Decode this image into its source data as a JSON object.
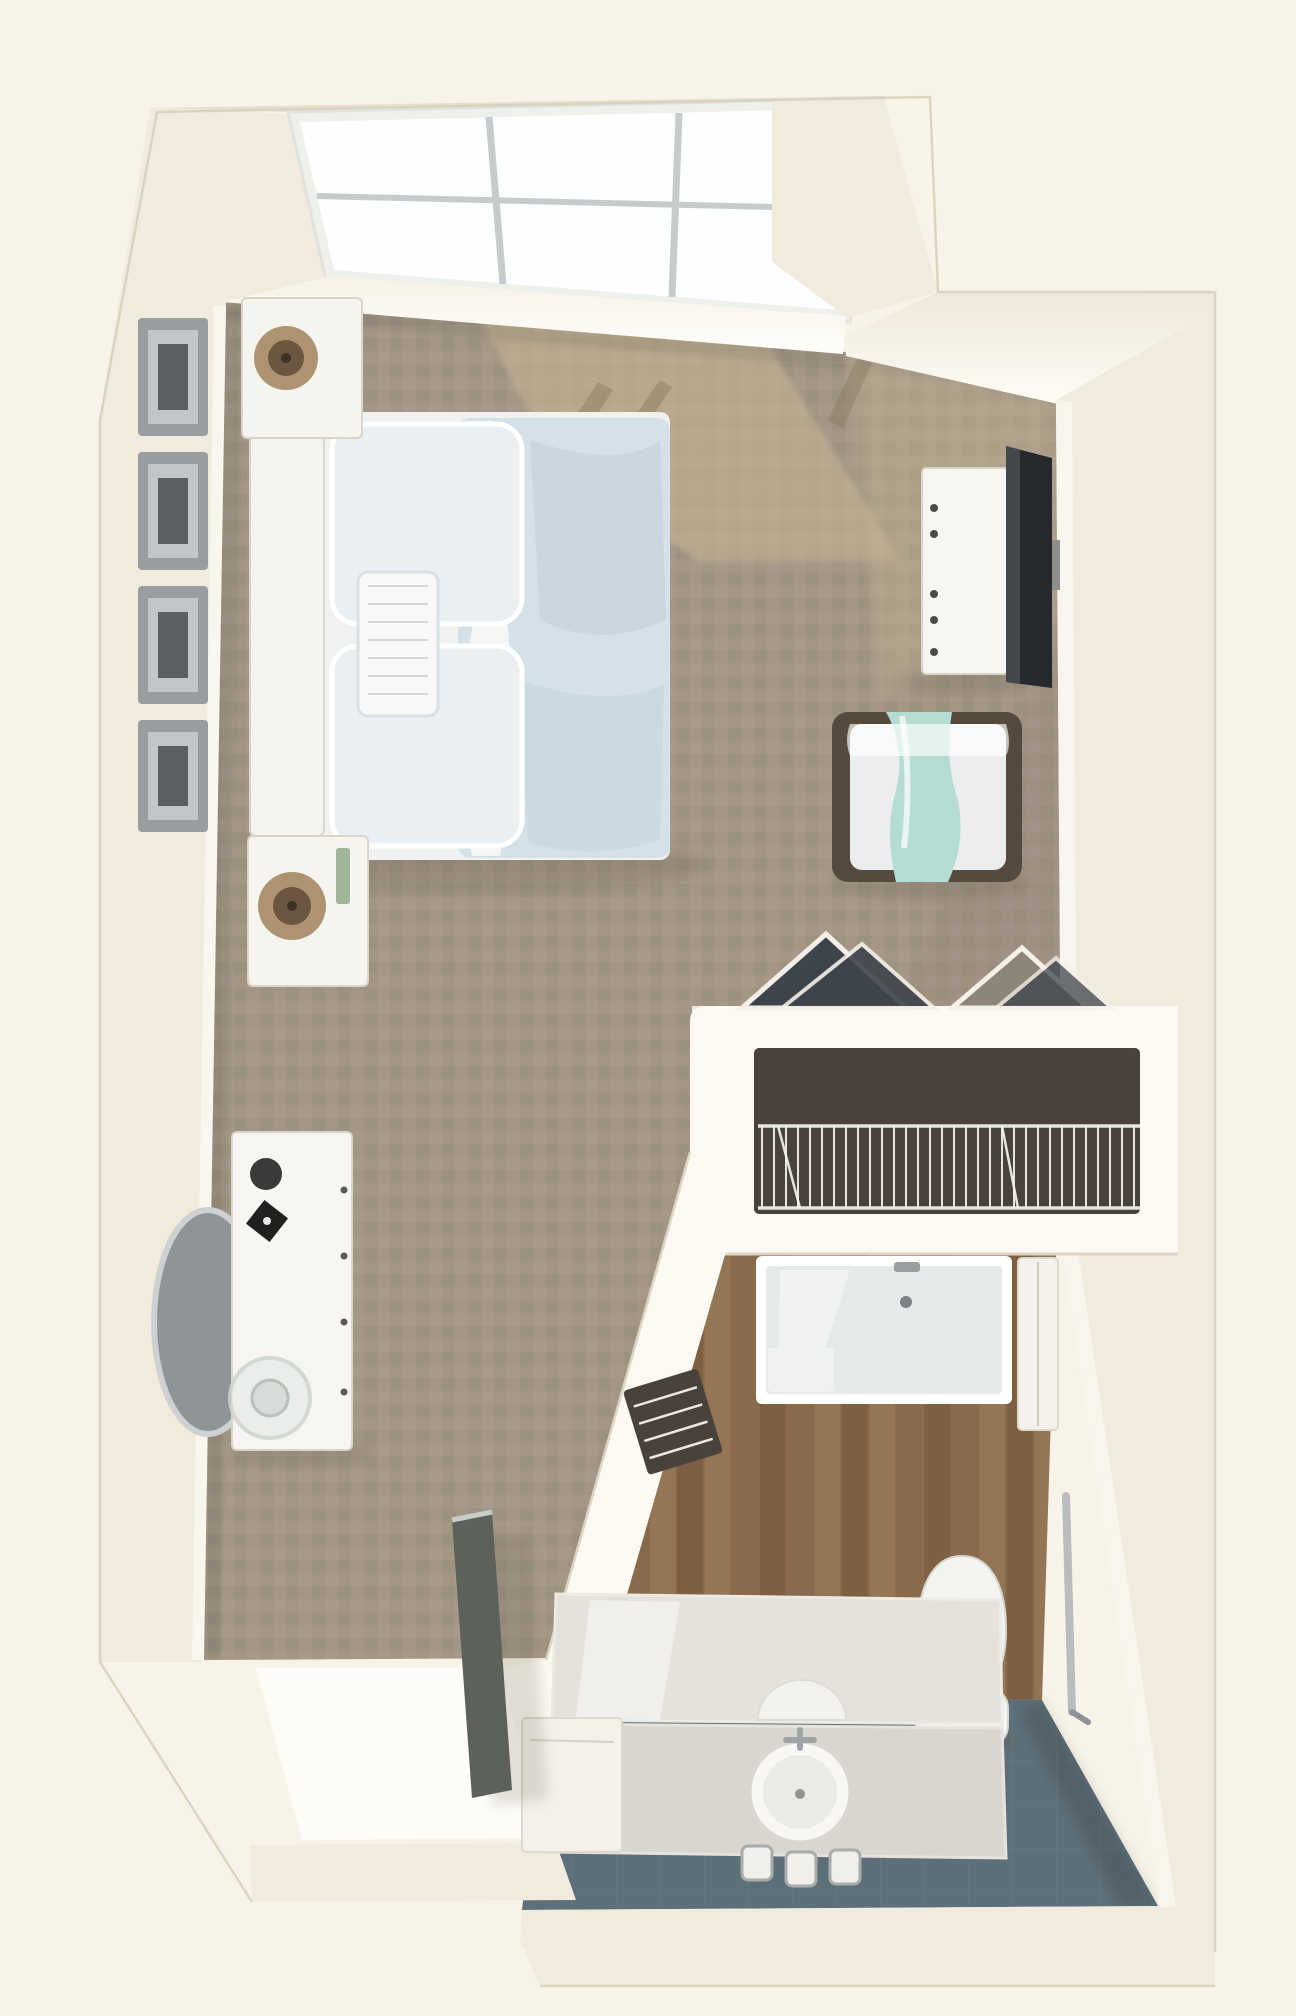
{
  "meta": {
    "title": "Studio Suite 3D Floor Plan",
    "view": "top-down isometric rendering",
    "canvas": {
      "width": 1296,
      "height": 2016
    }
  },
  "palette": {
    "background": "#f8f3e8",
    "wall": "#f1ebdd",
    "wall_bright": "#fbf9f1",
    "wall_edge": "#d8d0bd",
    "carpet": "#a39685",
    "carpet_dark": "#95887b",
    "sun_patch": "#c9b694",
    "sun_shadow": "#8a7a5f",
    "wood_floor": "#8a6a4c",
    "wood_light": "#9d7d5c",
    "wood_dark": "#755638",
    "tile_floor": "#5d6f78",
    "glass": "#fdfeff",
    "mullion": "#c6cbcb",
    "window_frame": "#eef0ec",
    "headboard": "#f4f3ef",
    "bed_base": "#f0f2f1",
    "pillow": "#e9eff3",
    "duvet": "#d5e1e8",
    "duvet_shade": "#bccdd8",
    "runner_white": "#f7f8f7",
    "nightstand": "#f5f4ef",
    "lamp_base": "#ad9372",
    "lamp_dark": "#6b573f",
    "art_frame": "#9a9da0",
    "art_dark": "#5c6063",
    "dresser": "#f6f5f1",
    "tv": "#25292d",
    "chair_frame": "#564a3d",
    "chair_cushion": "#eceded",
    "throw_teal": "#b5dcd2",
    "clothes_dark": "#3e444c",
    "clothes_light": "#8d8678",
    "closet_interior": "#49423a",
    "wire": "#f4f2ec",
    "shower": "#e6e9e9",
    "shower_hi": "#f3f5f4",
    "cabinet": "#f3f1ea",
    "counter": "#d9d6cf",
    "counter_light": "#e4e2db",
    "sink": "#f7f7f4",
    "toilet": "#f3f3ef",
    "door": "#5c615a",
    "mirror_face": "#8f9498",
    "mirror_rim": "#ced1d2",
    "grab_bar": "#b9bdbe",
    "threshold": "#fdfcf7",
    "shadow": "#6b6152"
  },
  "window": {
    "rows": 2,
    "cols": 3,
    "pane_count": 6
  },
  "rooms": [
    {
      "id": "main-room",
      "label": "Bedroom / Living Area",
      "floor": "carpet"
    },
    {
      "id": "closet",
      "label": "Closet",
      "floor": "carpet"
    },
    {
      "id": "bathroom",
      "label": "Bathroom",
      "floor": "wood and tile"
    },
    {
      "id": "entry",
      "label": "Entry",
      "floor": "threshold"
    }
  ],
  "furniture": {
    "bed": {
      "label": "Queen bed with light blue bedding"
    },
    "headboard": {
      "label": "Headboard"
    },
    "pillows": {
      "label": "Pillows"
    },
    "accent_cushion": {
      "label": "Accent cushion"
    },
    "nightstand_window": {
      "label": "Nightstand with lamp (window side)"
    },
    "nightstand_foot": {
      "label": "Nightstand with lamp (foot side)"
    },
    "wall_art": {
      "label": "Framed wall art",
      "count": 4
    },
    "media_dresser": {
      "label": "Media dresser"
    },
    "tv": {
      "label": "Wall-mounted TV"
    },
    "armchair": {
      "label": "Armchair with teal throw"
    },
    "desk": {
      "label": "Dresser desk with round mirror"
    },
    "mirror": {
      "label": "Round wall mirror"
    },
    "hanging_clothes": {
      "label": "Clothes on hangers",
      "count": 2
    },
    "wire_shelf": {
      "label": "Wire closet shelving"
    },
    "shower": {
      "label": "Walk-in shower"
    },
    "side_cabinet": {
      "label": "Bathroom storage cabinet"
    },
    "toilet": {
      "label": "Toilet"
    },
    "vanity": {
      "label": "Vanity with round sink and mirror"
    },
    "canisters": {
      "label": "Vanity canisters",
      "count": 3
    },
    "storage_cube": {
      "label": "Storage cabinet"
    },
    "grab_bar": {
      "label": "Grab bar"
    },
    "entry_door": {
      "label": "Entry door (open)"
    },
    "niche": {
      "label": "Wire niche shelf"
    }
  },
  "generators": {
    "planks": {
      "count": 19,
      "x0": 540,
      "x1": 1062,
      "y0": 1248,
      "y1": 1712
    },
    "wires": {
      "x0": 762,
      "x1": 1136,
      "step": 12,
      "y0": 1126,
      "y1": 1208
    }
  }
}
